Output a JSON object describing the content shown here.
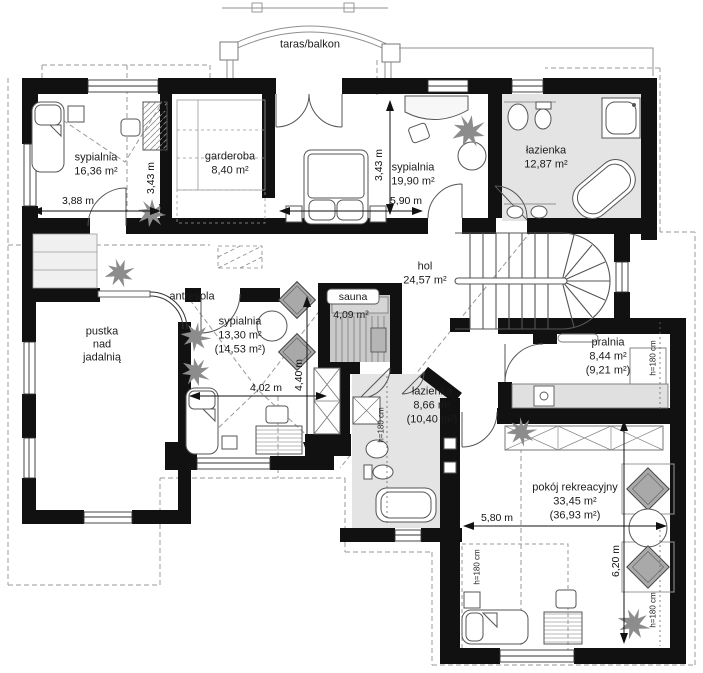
{
  "plan": {
    "terrace": {
      "label": "taras/balkon"
    },
    "rooms": {
      "bedroom1": {
        "name": "sypialnia",
        "area": "16,36 m²"
      },
      "wardrobe": {
        "name": "garderoba",
        "area": "8,40 m²"
      },
      "bedroom2": {
        "name": "sypialnia",
        "area": "19,90 m²"
      },
      "bathroom1": {
        "name": "łazienka",
        "area": "12,87 m²"
      },
      "hall": {
        "name": "hol",
        "area": "24,57 m²"
      },
      "mezzanine": {
        "name": "antresola"
      },
      "void": {
        "name": "pustka\nnad\njadalnią"
      },
      "bedroom3": {
        "name": "sypialnia",
        "area": "13,30 m²",
        "area_floor": "(14,53 m²)"
      },
      "sauna": {
        "name": "sauna",
        "area": "4,09 m²"
      },
      "bathroom2": {
        "name": "łazienka",
        "area": "8,66 m²",
        "area_floor": "(10,40 m²)"
      },
      "laundry": {
        "name": "pralnia",
        "area": "8,44 m²",
        "area_floor": "(9,21 m²)"
      },
      "recreation": {
        "name": "pokój rekreacyjny",
        "area": "33,45 m²",
        "area_floor": "(36,93 m²)"
      }
    },
    "dimensions": {
      "w_bedroom1": "3,88 m",
      "h_bedroom1": "3,43 m",
      "h_bedroom2": "3,43 m",
      "w_bedroom2": "5,90 m",
      "w_bedroom3": "4,02 m",
      "h_bedroom3": "4,40 m",
      "w_recreation": "5,80 m",
      "h_recreation": "6,20 m",
      "ceilings": [
        "h=180 cm",
        "h=180 cm",
        "h=180 cm",
        "h=180 cm"
      ]
    },
    "colors": {
      "wall": "#111111",
      "bath_floor": "#e4e4e4",
      "sauna_floor": "#c9c9c9",
      "furniture_gray": "#a9a9a9"
    }
  }
}
